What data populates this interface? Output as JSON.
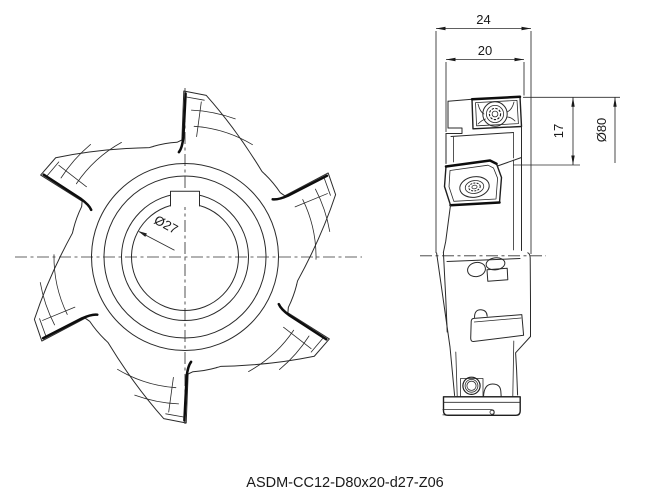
{
  "caption": "ASDM-CC12-D80x20-d27-Z06",
  "front_view": {
    "bore_diameter_label": "Ø27",
    "tooth_count": 6
  },
  "side_view": {
    "dims": {
      "overall_width": "24",
      "body_width": "20",
      "cutting_depth": "17",
      "outer_diameter": "Ø80"
    }
  },
  "colors": {
    "line": "#2a2a2a",
    "background": "#ffffff"
  }
}
